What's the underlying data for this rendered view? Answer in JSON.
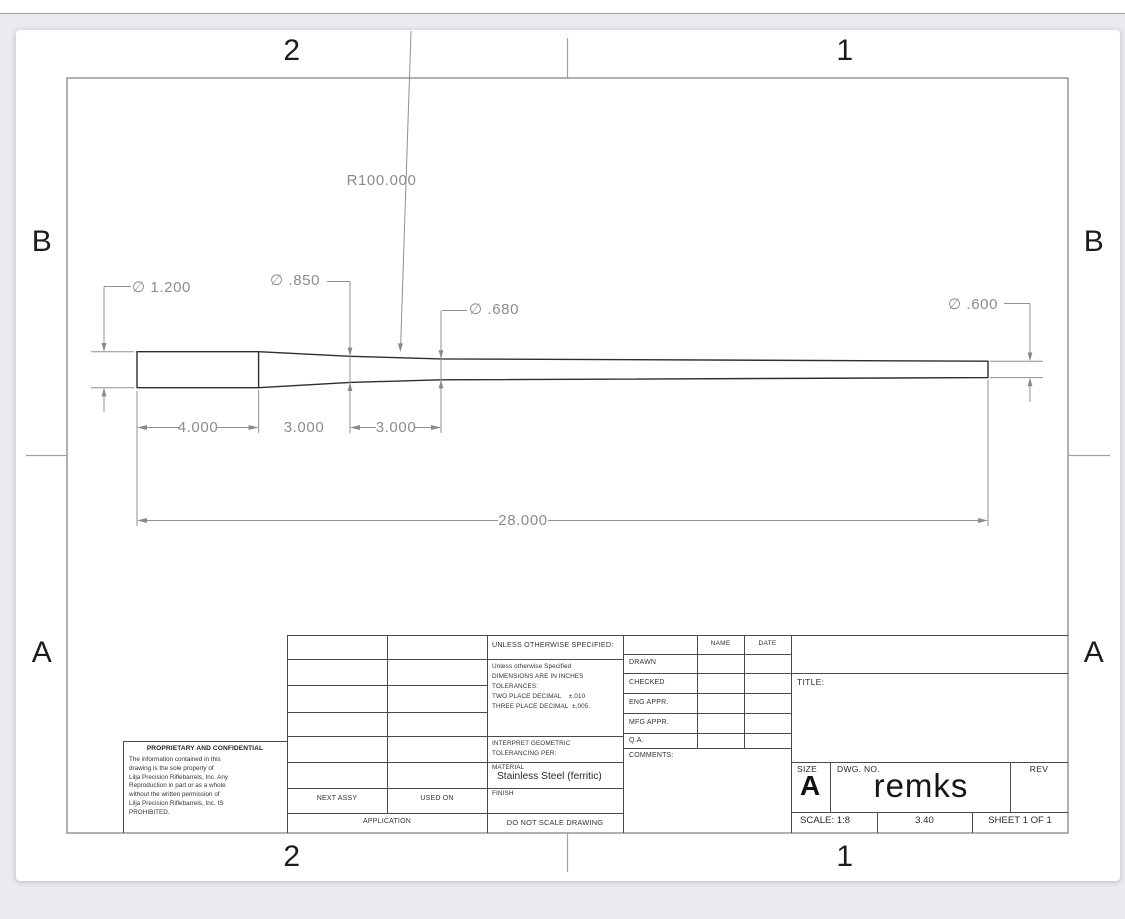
{
  "zones": {
    "top": [
      "2",
      "1"
    ],
    "bottom": [
      "2",
      "1"
    ],
    "left": [
      "B",
      "A"
    ],
    "right": [
      "B",
      "A"
    ]
  },
  "drawing": {
    "part": "tapered rifle barrel profile",
    "dimensions": {
      "radius_taper": "R100.000",
      "dia_breech": "∅ 1.200",
      "dia_mid": "∅ .850",
      "dia_transition": "∅ .680",
      "dia_muzzle": "∅ .600",
      "len_cylinder": "4.000",
      "len_taper1": "3.000",
      "len_taper2": "3.000",
      "len_overall": "28.000"
    }
  },
  "title_block": {
    "proprietary": {
      "heading": "PROPRIETARY AND CONFIDENTIAL",
      "body": "The information contained in this\ndrawing is the sole property of\nLilja Precision Riflebarrels, Inc. Any\nReproduction in part or as a whole\nwithout the written permission of\nLilja Precision Riflebarrels, Inc. IS\nPROHIBITED."
    },
    "application": {
      "next_assy": "NEXT ASSY",
      "used_on": "USED ON",
      "label": "APPLICATION"
    },
    "specs": {
      "unless": "UNLESS OTHERWISE SPECIFIED:",
      "tolerances": "Unless otherwise Specified\nDIMENSIONS ARE IN INCHES\nTOLERANCES:\nTWO PLACE DECIMAL    ±.010\nTHREE PLACE DECIMAL  ±.005.",
      "interpret": "INTERPRET GEOMETRIC\nTOLERANCING PER:",
      "material_label": "MATERIAL",
      "material_value": "Stainless Steel (ferritic)",
      "finish_label": "FINISH",
      "do_not_scale": "DO NOT SCALE DRAWING"
    },
    "approvals": {
      "name_header": "NAME",
      "date_header": "DATE",
      "rows": [
        "DRAWN",
        "CHECKED",
        "ENG APPR.",
        "MFG APPR.",
        "Q.A."
      ],
      "comments_label": "COMMENTS:"
    },
    "title_label": "TITLE:",
    "size_label": "SIZE",
    "size_value": "A",
    "dwg_label": "DWG. NO.",
    "dwg_value": "remks",
    "rev_label": "REV",
    "scale": "SCALE: 1:8",
    "weight": "3.40",
    "sheet": "SHEET 1 OF 1"
  }
}
